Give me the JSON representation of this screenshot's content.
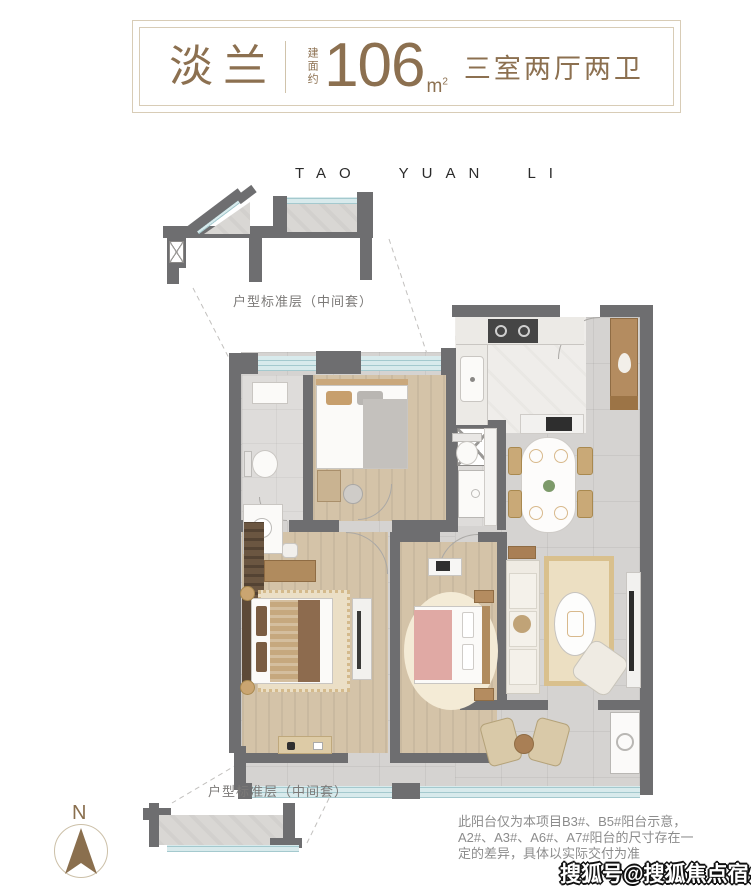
{
  "header": {
    "plan_name": "淡兰",
    "area_prefix": "建面约",
    "area_value": "106",
    "area_unit": "m",
    "area_unit_sup": "2",
    "layout_desc": "三室两厅两卫"
  },
  "project_name": "TAO YUAN LI",
  "top_detail_label": "户型标准层（中间套）",
  "bottom_detail_label": "户型标准层（中间套）",
  "compass_label": "N",
  "disclaimer": {
    "line1": "此阳台仅为本项目B3#、B5#阳台示意，",
    "line2": "A2#、A3#、A6#、A7#阳台的尺寸存在一",
    "line3": "定的差异，具体以实际交付为准"
  },
  "watermark": "搜狐号@搜狐焦点宿州站",
  "colors": {
    "accent_brown": "#8a6f4e",
    "wall_gray": "#6e6e70",
    "glass_blue": "#d8eaec",
    "border_tan": "#d8ccb6"
  }
}
